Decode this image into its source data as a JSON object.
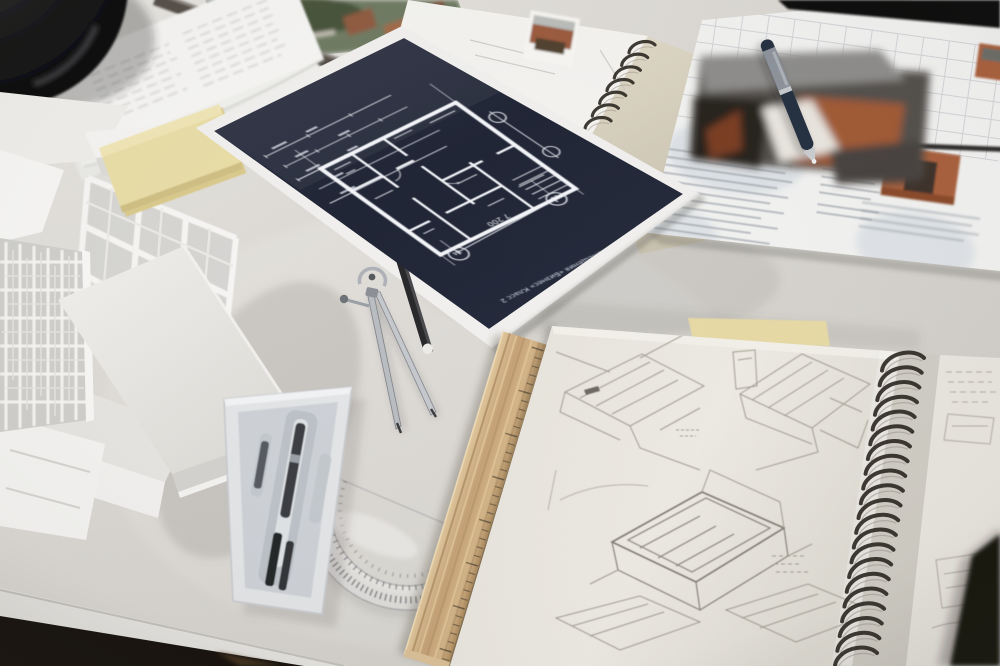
{
  "scene": {
    "description": "Photograph of an architect's desk seen from above at an angle: dark navy floor-plan print, white architectural scale model, sketchbook with pencil drawings, drafting tools (compass, protractor, wooden ruler, pencil, pen, instrument case), sticky notes and technical sheets.",
    "palette": {
      "desk": "#d8d5d0",
      "blueprint_paper": "#232838",
      "blueprint_lines": "#f2f4f8",
      "sticky_note": "#e8dca6",
      "wood_ruler": "#c9a87d",
      "sketch_paper": "#e9e6df",
      "floor": "#1a1510",
      "render_brick": "#a8613c"
    }
  },
  "blueprint": {
    "caption": "Тип помещения «Бизнес» Класс 2",
    "subcaption": "Масштаб 1:75",
    "dimension_label": "7 200",
    "bubble_left": "14",
    "bubble_right": "13"
  },
  "objects": [
    {
      "name": "camera-lens",
      "description": "dark round object in top-left corner"
    },
    {
      "name": "document-stack",
      "description": "fanned white printed papers, top-left"
    },
    {
      "name": "site-photo",
      "description": "green aerial photo print at top edge with metal ruler lying across it"
    },
    {
      "name": "spiral-notebook-top",
      "description": "cream spiral notebook with white sheet and small colour render"
    },
    {
      "name": "technical-sheet",
      "description": "white specification sheet top-right with table grid, text and brick-coloured detail renders"
    },
    {
      "name": "pen",
      "description": "dark blue pen lying on the technical sheet"
    },
    {
      "name": "blueprint",
      "description": "dark navy floor plan print on white backing sheet"
    },
    {
      "name": "architect-model",
      "description": "white cardboard building model with lattice screen and mullioned facade"
    },
    {
      "name": "sticky-pad",
      "description": "pale yellow sticky note pad"
    },
    {
      "name": "compass",
      "description": "steel drafting bow compass"
    },
    {
      "name": "pencil",
      "description": "black pencil with white tip"
    },
    {
      "name": "protractor",
      "description": "clear plastic protractor"
    },
    {
      "name": "ruler",
      "description": "wooden ruler"
    },
    {
      "name": "instrument-case",
      "description": "white plastic case with drafting instruments"
    },
    {
      "name": "sketchbook",
      "description": "spiral-bound sketchbook with pencil building sketches"
    },
    {
      "name": "dark-object",
      "description": "blurred dark object entering bottom-right corner"
    }
  ]
}
